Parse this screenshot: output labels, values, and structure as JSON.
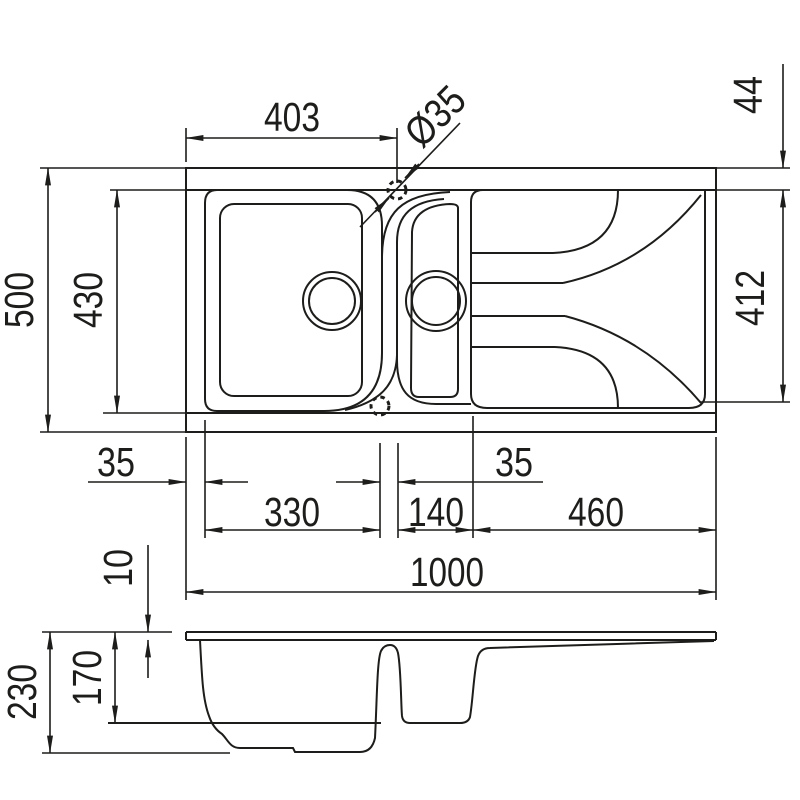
{
  "colors": {
    "line": "#1d1d1b",
    "background": "#ffffff"
  },
  "dimensions": {
    "top": {
      "width_to_tap": "403",
      "tap_diameter": "Ø35",
      "top_rim": "44",
      "overall_depth": "500",
      "bowl_depth": "430",
      "drainer_depth": "412",
      "left_rim": "35",
      "main_bowl_width": "330",
      "bowl_gap": "35",
      "half_bowl_width": "140",
      "drainer_width": "460",
      "overall_width": "1000"
    },
    "section": {
      "rim_thickness": "10",
      "bowl_inner_depth": "170",
      "overall_height": "230"
    }
  }
}
